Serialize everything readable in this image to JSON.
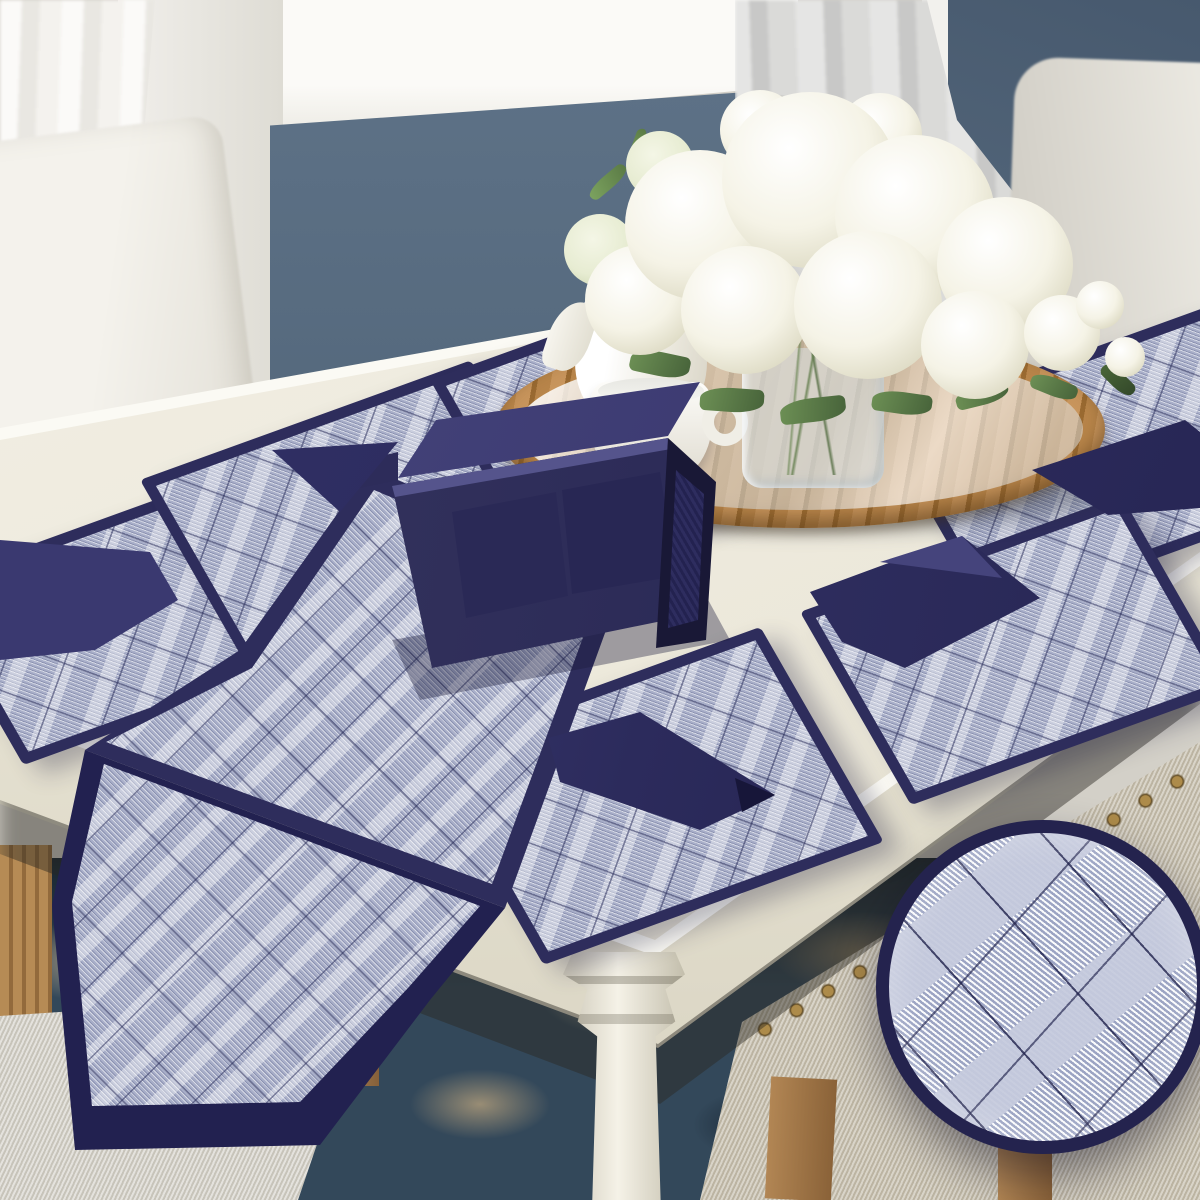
{
  "image_type": "product-photograph",
  "description": "Navy blue quilted dining linen set (placemats, napkins, table runner, tissue/cutlery holder) arranged on a cream dining table with a rattan tray, white tea set and white hydrangea centerpiece; a circular magnifier inset shows the fabric weave.",
  "palette": {
    "navy": "#2e2d5c",
    "navy-dark": "#222150",
    "navy-light": "#4a4980",
    "mat-base": "#a9afc9",
    "wall-blue": "#5a6e83",
    "wall-blue-right": "#4e6277",
    "window-white": "#f6f5f1",
    "curtain-left": "#f2f1ed",
    "curtain-right": "#d7d7d5",
    "chair-cream": "#efede7",
    "chair-gray": "#d8d5cf",
    "table-cream": "#f1eee4",
    "table-apron": "#e6e2d3",
    "tray-gold": "#b27c3e",
    "porcelain": "#f8f7f2",
    "leaf-green": "#5d7d49",
    "flower-white": "#f7f5ea",
    "rug-teal": "#33485a",
    "rug-tan": "#b08a5a",
    "bench-beige": "#c9c2b1",
    "seat-gray": "#d8d6cf",
    "wood": "#a97f4e",
    "nailhead": "#ad8b4a"
  },
  "scene": {
    "labels": {
      "scene": "dining room product photo",
      "wall": "blue-gray wainscoted wall",
      "window": "white window frame and sill",
      "curtain_left": "sheer white curtain",
      "curtain_right": "gray curtain with tieback",
      "chair_left": "white upholstered dining chair",
      "chair_right": "white upholstered dining chair",
      "table": "cream dining table",
      "placemat": "navy-trimmed quilted placemat",
      "napkin": "folded navy dinner napkin",
      "runner": "navy-trimmed quilted table runner",
      "holder": "navy fabric tissue and cutlery holder",
      "tray": "round rattan serving tray",
      "teapot": "white porcelain teapot",
      "teacup": "white porcelain cup",
      "vase": "glass vase",
      "bouquet": "white hydrangea bouquet",
      "rug": "dark patterned area rug",
      "bench": "beige upholstered bench with nailhead trim",
      "cushion": "gray chair seat cushion",
      "magnifier": "fabric texture magnifier inset"
    }
  }
}
